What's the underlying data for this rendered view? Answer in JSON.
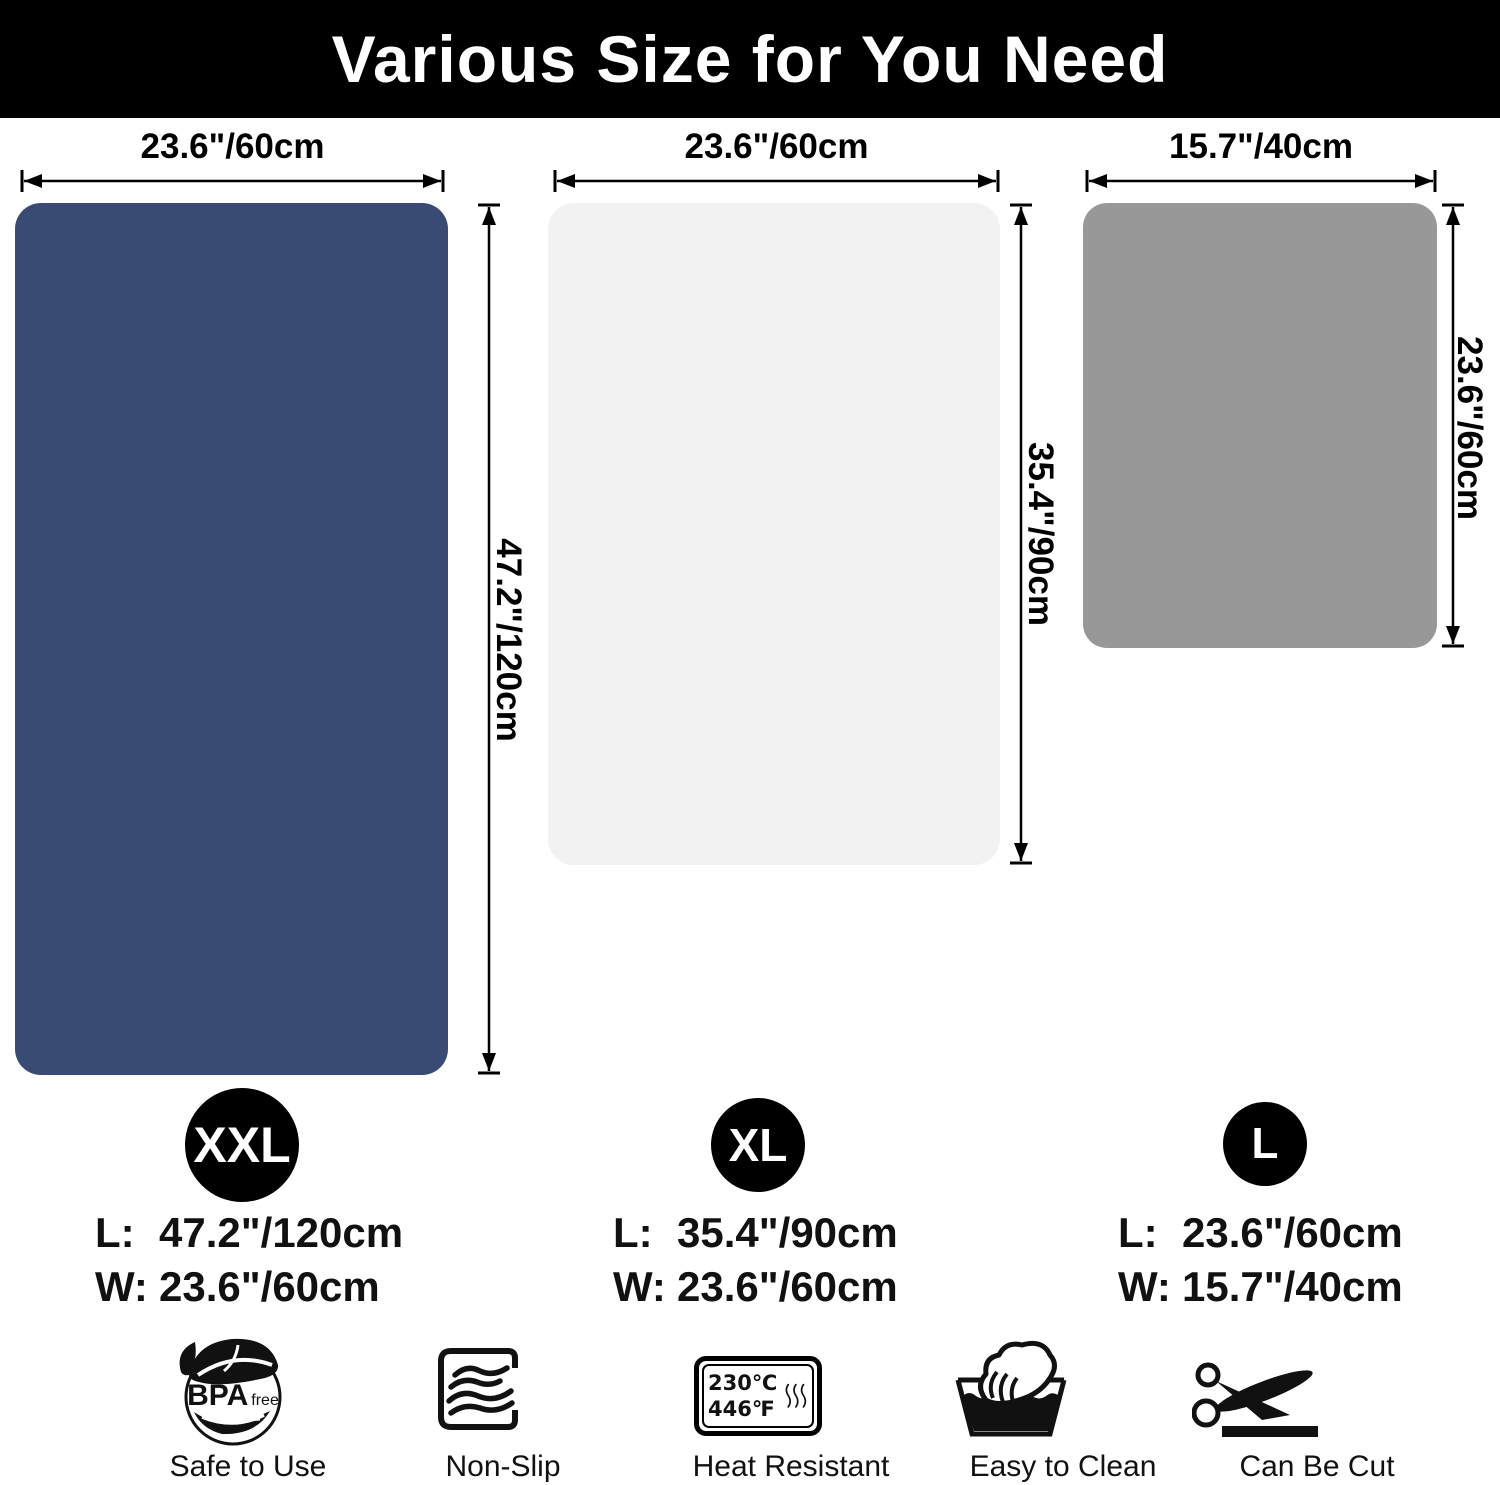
{
  "header": {
    "title": "Various Size for You Need",
    "bg_color": "#000000",
    "text_color": "#ffffff"
  },
  "mats": [
    {
      "name": "XXL",
      "color": "#394a75",
      "width_label": "23.6\"/60cm",
      "height_label": "47.2\"/120cm"
    },
    {
      "name": "XL",
      "color": "#f2f2f2",
      "width_label": "23.6\"/60cm",
      "height_label": "35.4\"/90cm"
    },
    {
      "name": "L",
      "color": "#989898",
      "width_label": "15.7\"/40cm",
      "height_label": "23.6\"/60cm"
    }
  ],
  "sizes": [
    {
      "badge": "XXL",
      "length_key": "L:",
      "length_value": "47.2\"/120cm",
      "width_key": "W:",
      "width_value": "23.6\"/60cm"
    },
    {
      "badge": "XL",
      "length_key": "L:",
      "length_value": "35.4\"/90cm",
      "width_key": "W:",
      "width_value": "23.6\"/60cm"
    },
    {
      "badge": "L",
      "length_key": "L:",
      "length_value": "23.6\"/60cm",
      "width_key": "W:",
      "width_value": "15.7\"/40cm"
    }
  ],
  "features": [
    {
      "icon": "bpa-free-leaf-icon",
      "label": "Safe to Use",
      "icon_text_main": "BPA",
      "icon_text_sub": "free"
    },
    {
      "icon": "non-slip-waves-icon",
      "label": "Non-Slip"
    },
    {
      "icon": "heat-resistant-icon",
      "label": "Heat Resistant",
      "temp_c": "230℃",
      "temp_f": "446℉"
    },
    {
      "icon": "wash-hand-icon",
      "label": "Easy to Clean"
    },
    {
      "icon": "scissors-cut-icon",
      "label": "Can Be Cut"
    }
  ]
}
